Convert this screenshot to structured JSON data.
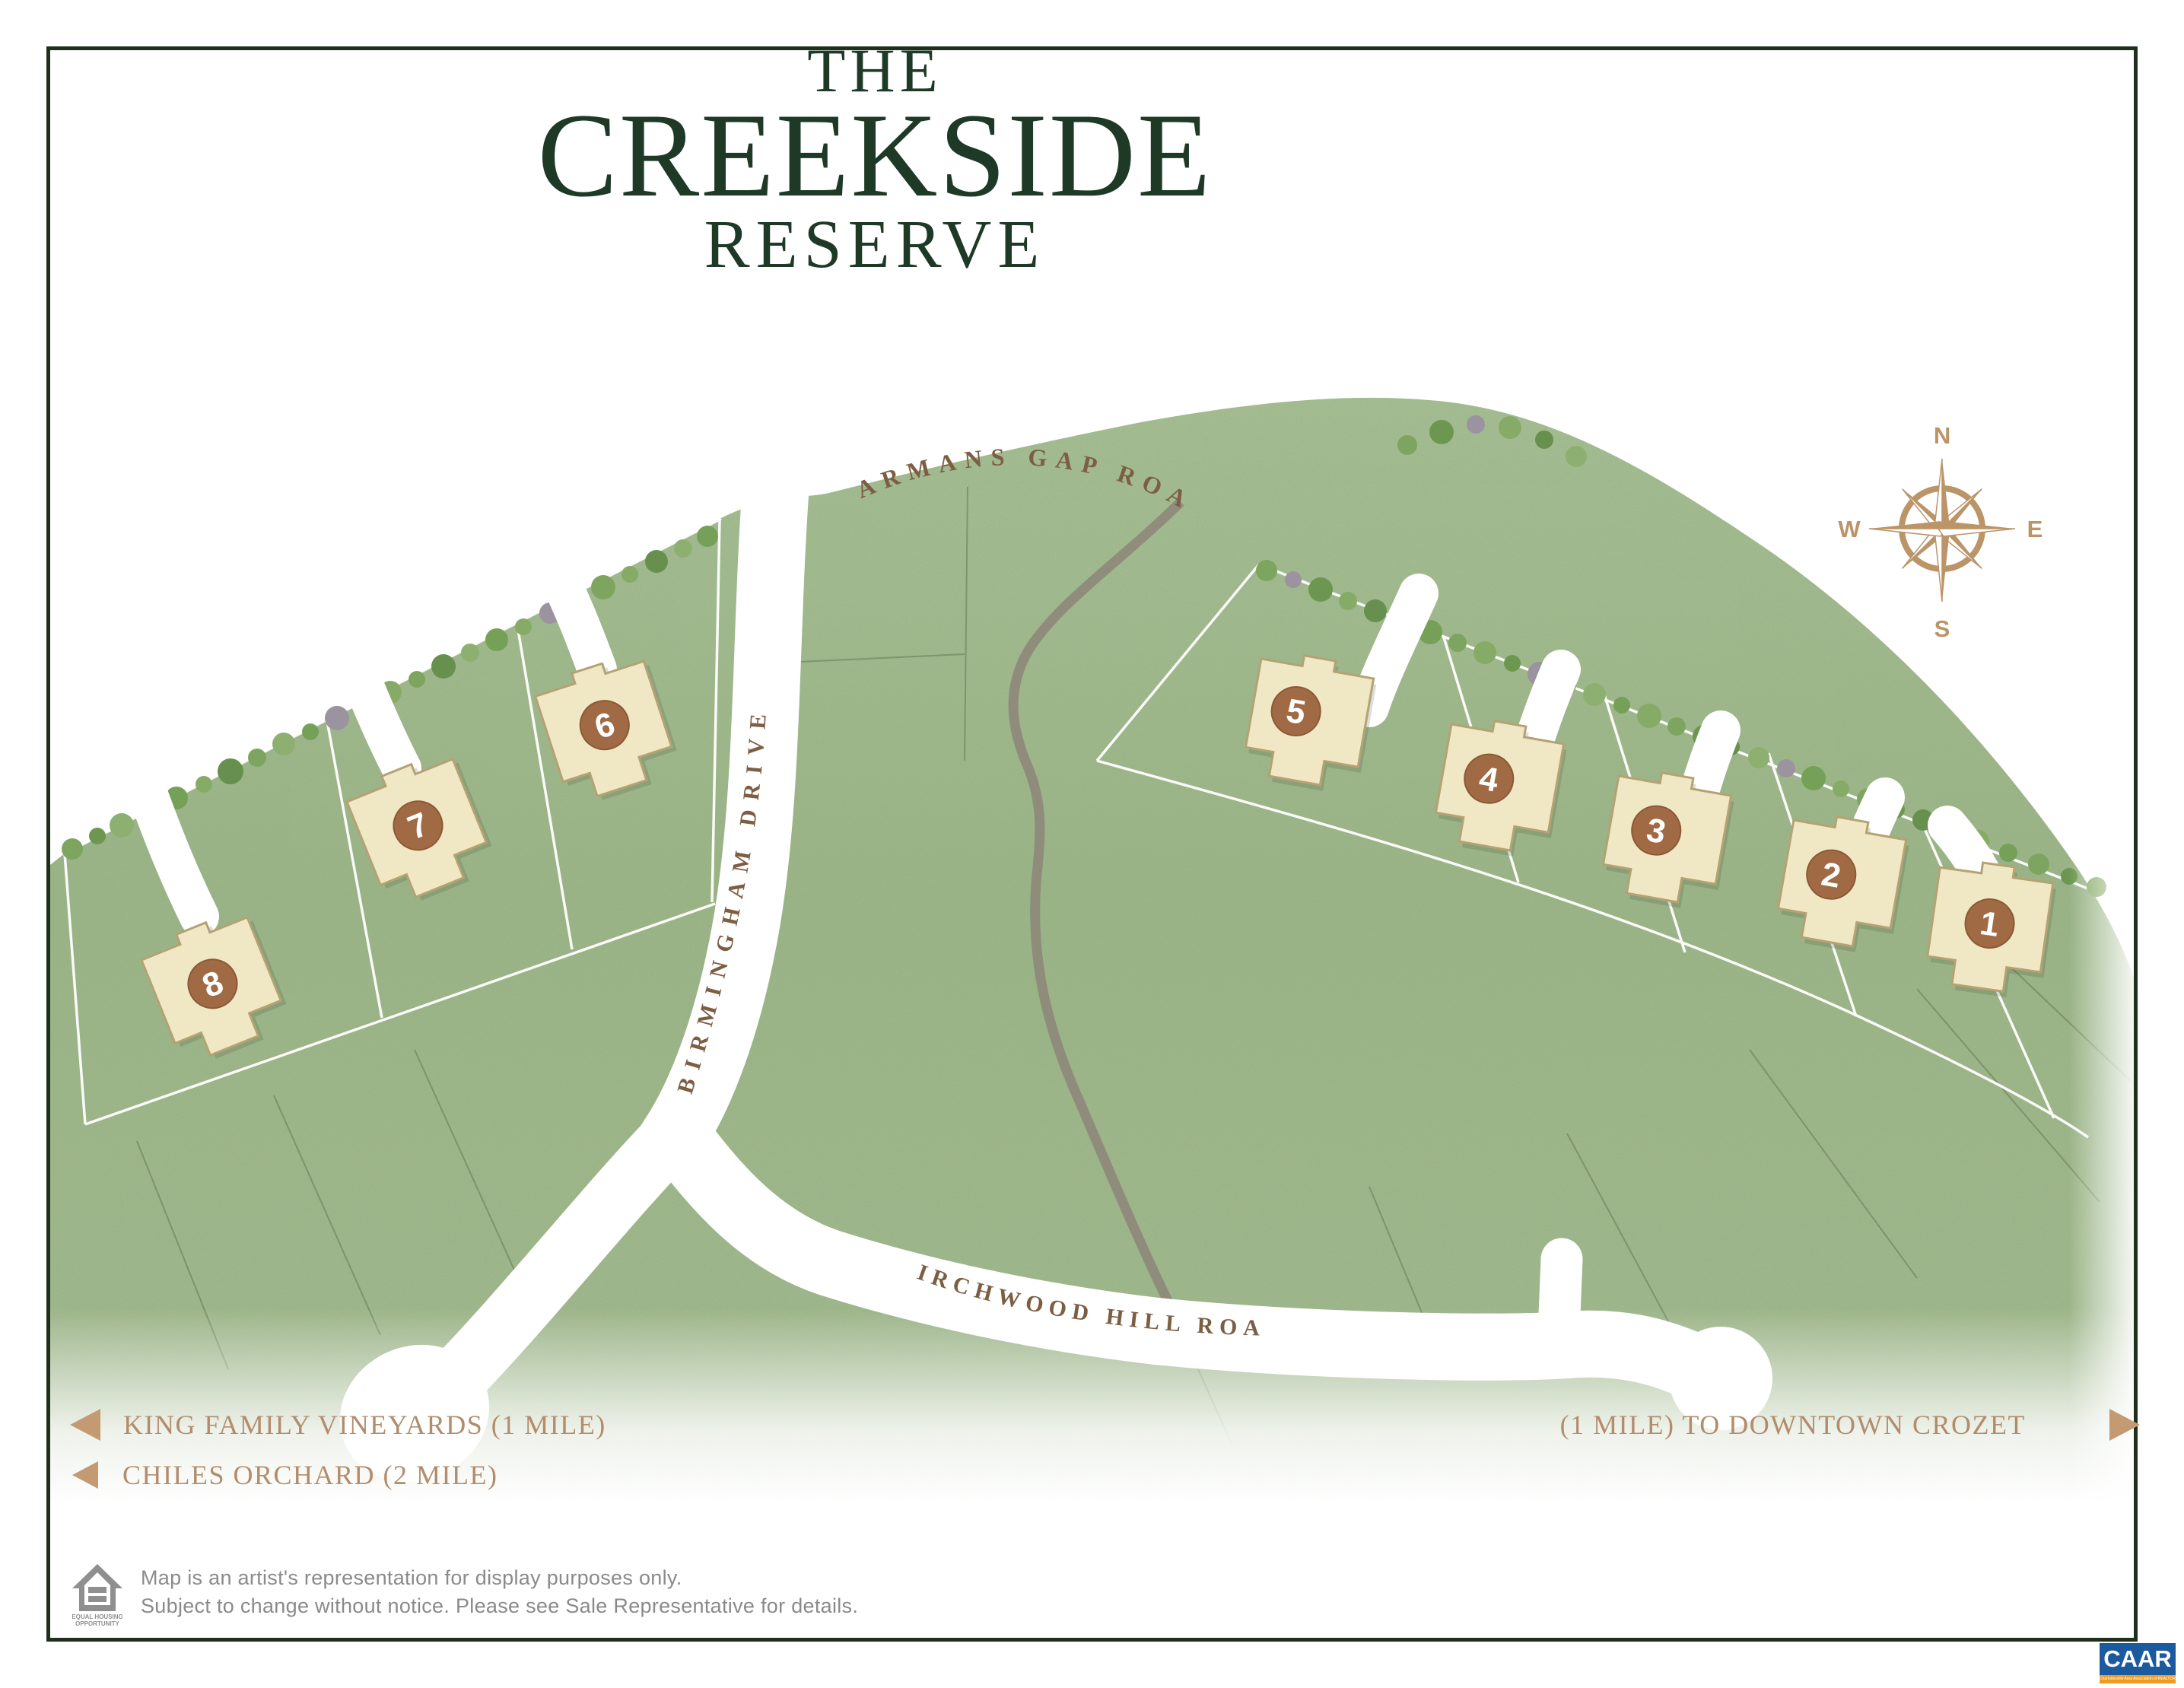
{
  "title": {
    "line1": "THE",
    "line2": "CREEKSIDE",
    "line3": "RESERVE"
  },
  "roads": {
    "jarmans_gap": "JARMANS GAP ROAD",
    "birmingham": "BIRMINGHAM DRIVE",
    "birchwood_hill": "BIRCHWOOD HILL ROAD"
  },
  "compass": {
    "north": "N",
    "east": "E",
    "south": "S",
    "west": "W"
  },
  "lots": [
    {
      "number": "1"
    },
    {
      "number": "2"
    },
    {
      "number": "3"
    },
    {
      "number": "4"
    },
    {
      "number": "5"
    },
    {
      "number": "6"
    },
    {
      "number": "7"
    },
    {
      "number": "8"
    }
  ],
  "directions": {
    "king_family": "KING FAMILY VINEYARDS (1 MILE)",
    "chiles_orchard": "CHILES ORCHARD (2 MILE)",
    "downtown_crozet": "(1 MILE) TO DOWNTOWN CROZET"
  },
  "disclaimer": {
    "line1": "Map is an artist's representation for display purposes only.",
    "line2": "Subject to change without notice. Please see Sale Representative for details.",
    "eho_line1": "EQUAL HOUSING",
    "eho_line2": "OPPORTUNITY"
  },
  "caar": {
    "acronym": "CAAR",
    "tagline": "Charlottesville Area Association of REALTORS®"
  },
  "colors": {
    "map_green": "#9fb98c",
    "title_green": "#1e3a27",
    "accent_tan": "#bb9468",
    "road_label_brown": "#7c5e43",
    "house_fill": "#f0e8c4",
    "badge_brown": "#a06a45",
    "frame_green": "#1e301c",
    "caar_blue": "#1c5aa0",
    "caar_orange": "#ef9b20"
  }
}
